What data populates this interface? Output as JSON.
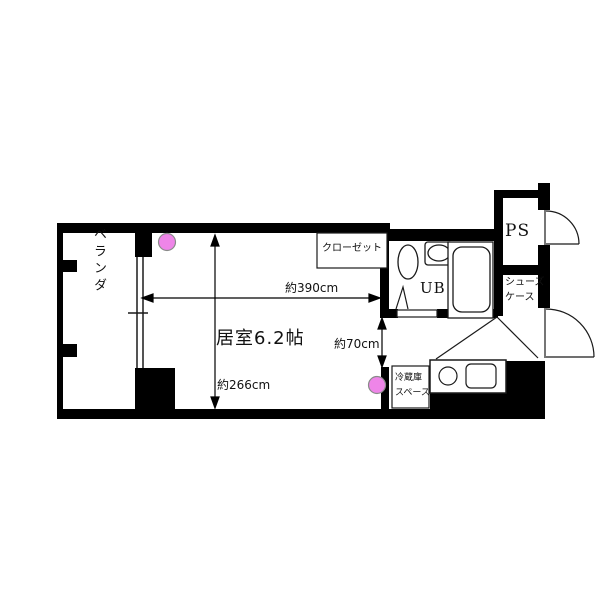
{
  "title": "floor-plan",
  "colors": {
    "wall": "#000000",
    "line": "#1a1a1a",
    "light_fixture_fill": "#ee85e8",
    "light_fixture_stroke": "#8a8a8a",
    "background": "#ffffff"
  },
  "rooms": {
    "balcony": {
      "label": "ベランダ"
    },
    "living": {
      "label": "居室6.2帖"
    },
    "closet": {
      "label": "クローゼット"
    },
    "unit_bath": {
      "label": "UB"
    },
    "pipe_space": {
      "label": "PS"
    },
    "shoe_case": {
      "label": "シューズ\nケース"
    },
    "fridge_space": {
      "label": "冷蔵庫\nスペース"
    }
  },
  "dimensions": {
    "room_width": {
      "label": "約390cm"
    },
    "room_depth": {
      "label": "約266cm"
    },
    "passage": {
      "label": "約70cm"
    }
  }
}
